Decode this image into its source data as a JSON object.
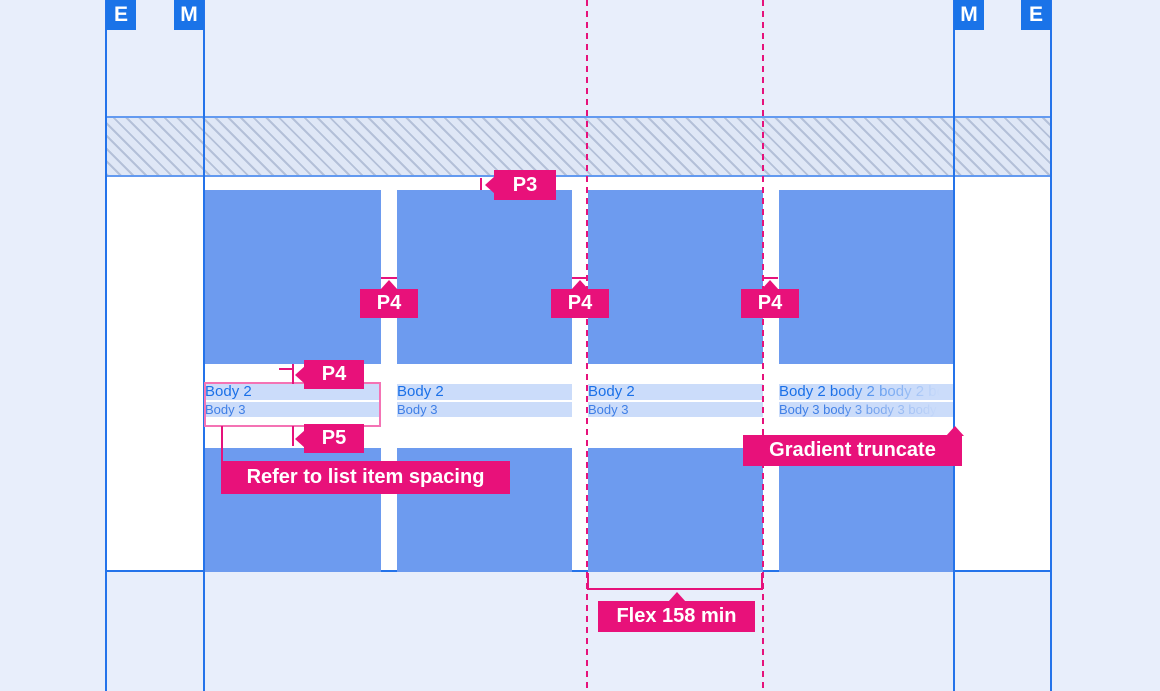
{
  "keyline_markers": {
    "left_outer": "E",
    "left_inner": "M",
    "right_inner": "M",
    "right_outer": "E"
  },
  "cards": [
    {
      "body2": "Body 2",
      "body3": "Body 3"
    },
    {
      "body2": "Body 2",
      "body3": "Body 3"
    },
    {
      "body2": "Body 2",
      "body3": "Body 3"
    },
    {
      "body2": "Body 2 body 2 body 2 body 2",
      "body3": "Body 3 body 3 body 3 body 3 body 3",
      "truncated": true
    }
  ],
  "annotations": {
    "p3": "P3",
    "p4_gap_1": "P4",
    "p4_gap_2": "P4",
    "p4_gap_3": "P4",
    "p4_text_spacing": "P4",
    "p5": "P5",
    "list_item_note": "Refer to list item spacing",
    "gradient_truncate": "Gradient truncate",
    "flex_min": "Flex 158 min"
  },
  "colors": {
    "accent_pink": "#E8117A",
    "outline_pink": "#F473B4",
    "tile_blue": "#6D9BEF",
    "keyline_blue": "#2473EA",
    "marker_blue": "#1A73E8",
    "body_text_blue": "#1A70E8",
    "text_row_bg": "#CBDCFA",
    "margin_bg": "#E8EEFB",
    "content_bg": "#FFFFFF"
  }
}
